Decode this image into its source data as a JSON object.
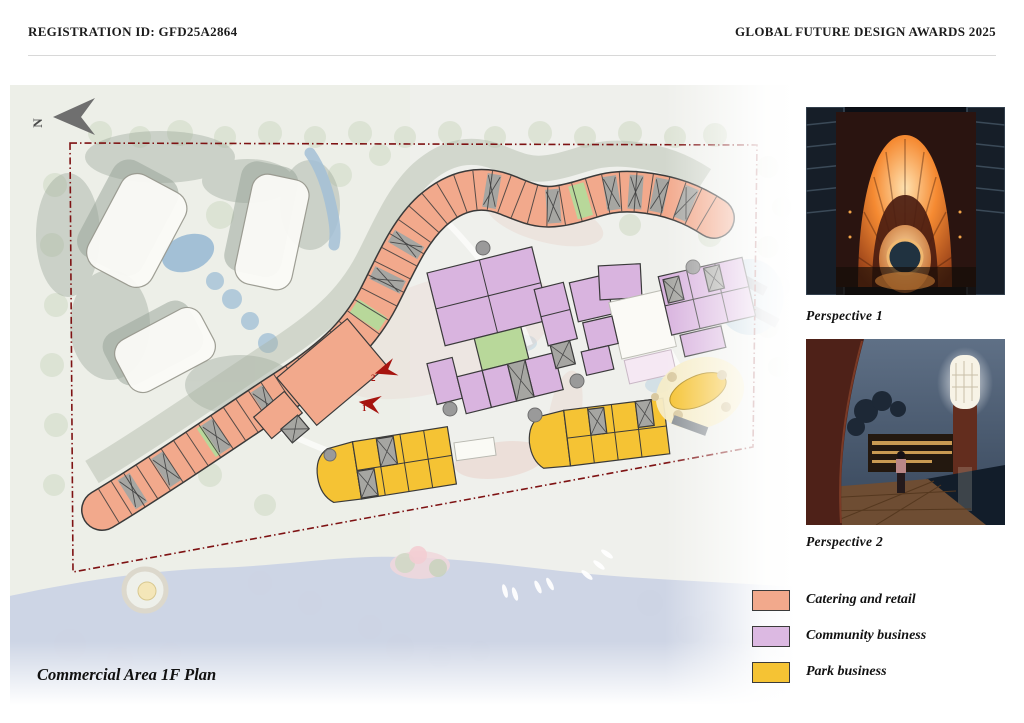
{
  "header": {
    "registration": "REGISTRATION ID: GFD25A2864",
    "award": "GLOBAL FUTURE DESIGN AWARDS 2025"
  },
  "plan": {
    "title": "Commercial Area 1F Plan",
    "north_label": "N",
    "entrance_markers": [
      {
        "label": "1"
      },
      {
        "label": "2"
      }
    ]
  },
  "sidebar": {
    "perspectives": [
      {
        "caption": "Perspective 1"
      },
      {
        "caption": "Perspective 2"
      }
    ],
    "legend": [
      {
        "label": "Catering and retail",
        "color": "#F2A98C"
      },
      {
        "label": "Community business",
        "color": "#DCB9E2"
      },
      {
        "label": "Park business",
        "color": "#F5C334"
      }
    ]
  },
  "colors": {
    "catering": "#F2A98C",
    "community": "#D9B4DF",
    "park": "#F5C334",
    "green_unit": "#B8D89A",
    "core_gray": "#A6A6A2",
    "boundary": "#7E1213",
    "arrow_red": "#A6140F",
    "water": "#CBD3E5",
    "pond": "#A3C0D6",
    "canvas": "#EDEFE8",
    "tree": "#CDD8C3",
    "shadow": "#96A295",
    "path_pink": "#E9D2CA",
    "building_white": "#FBFBF7"
  }
}
